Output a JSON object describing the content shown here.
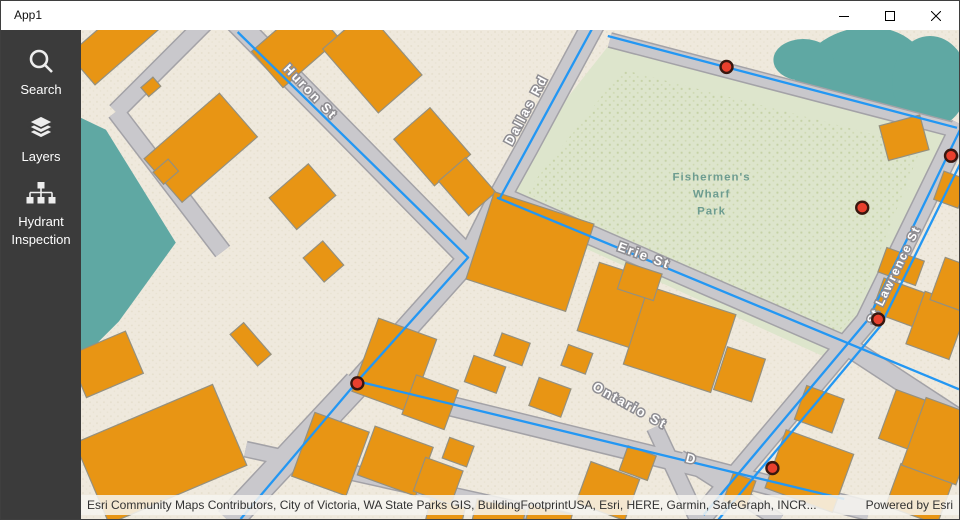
{
  "window": {
    "title": "App1"
  },
  "sidebar": {
    "items": [
      {
        "id": "search",
        "label": "Search"
      },
      {
        "id": "layers",
        "label": "Layers"
      },
      {
        "id": "hydrant-inspection",
        "label": "Hydrant Inspection",
        "label_lines": [
          "Hydrant",
          "Inspection"
        ]
      }
    ]
  },
  "map": {
    "street_labels": {
      "huron": "Huron St",
      "dallas": "Dallas Rd",
      "erie": "Erie St",
      "ontario": "Ontario St",
      "st_lawrence": "St Lawrence St",
      "partial": "D"
    },
    "park": {
      "name": "Fishermen's Wharf Park",
      "lines": [
        "Fishermen's",
        "Wharf",
        "Park"
      ]
    },
    "hydrants": [
      {
        "x": 647,
        "y": 37
      },
      {
        "x": 872,
        "y": 126
      },
      {
        "x": 783,
        "y": 178
      },
      {
        "x": 799,
        "y": 290
      },
      {
        "x": 277,
        "y": 354
      },
      {
        "x": 693,
        "y": 439
      }
    ],
    "colors": {
      "water": "#5fa8a3",
      "park": "#dde5cc",
      "ground": "#efe9dd",
      "building": "#e89514",
      "building_outline": "#95907e",
      "street": "#c9c8cc",
      "street_casing": "#a3a2a7",
      "water_line": "#2397f3",
      "hydrant": "#e8402e",
      "hydrant_outline": "#38170f",
      "park_text": "#6d9c90",
      "sidebar_bg": "#3b3b3b"
    }
  },
  "attribution": {
    "sources": "Esri Community Maps Contributors, City of Victoria, WA State Parks GIS, BuildingFootprintUSA, Esri, HERE, Garmin, SafeGraph, INCR...",
    "powered_by": "Powered by Esri"
  }
}
